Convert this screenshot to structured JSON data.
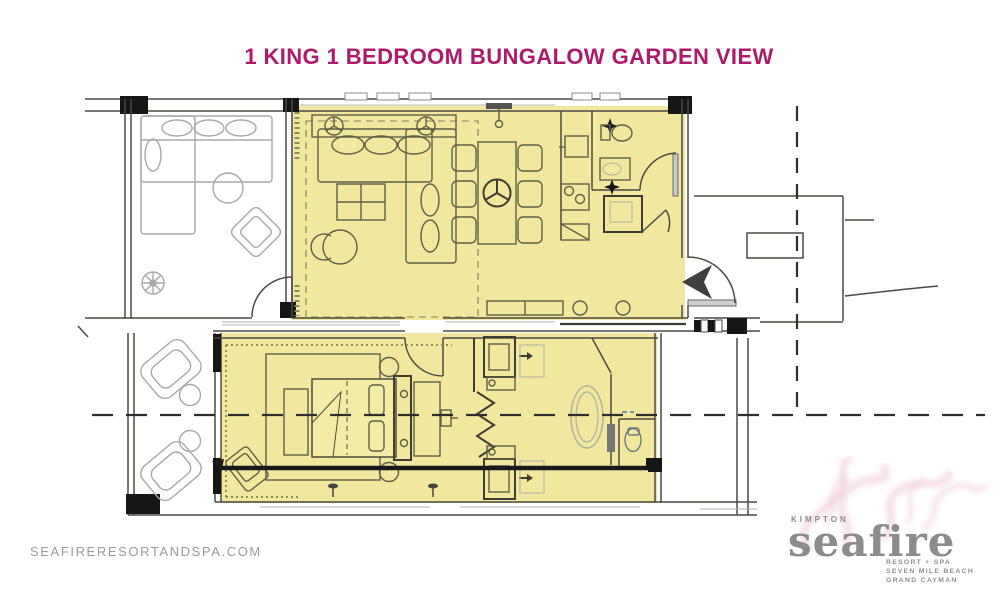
{
  "title": {
    "text": "1 KING 1 BEDROOM BUNGALOW GARDEN VIEW",
    "color": "#ad1a6b"
  },
  "footer": {
    "website": "SEAFIRERESORTANDSPA.COM"
  },
  "logo": {
    "brand": "KIMPTON",
    "resort_name": "seafire",
    "tagline1": "RESORT + SPA",
    "tagline2": "SEVEN MILE BEACH",
    "tagline3": "GRAND CAYMAN",
    "text_color": "#8c8c8c",
    "smoke_color": "#eab6c8"
  },
  "floorplan": {
    "highlight_color": "#f2e79e",
    "wall_color": "#3c3c3c",
    "furniture_color": "#5f5f48",
    "neighbor_furniture_color": "#a8a8a8",
    "entry_arrow_color": "#3f3f3f",
    "icons": [
      "entry-arrow-icon",
      "ceiling-fan-icon",
      "light-fixture-icon",
      "pendant-light-icon"
    ]
  }
}
